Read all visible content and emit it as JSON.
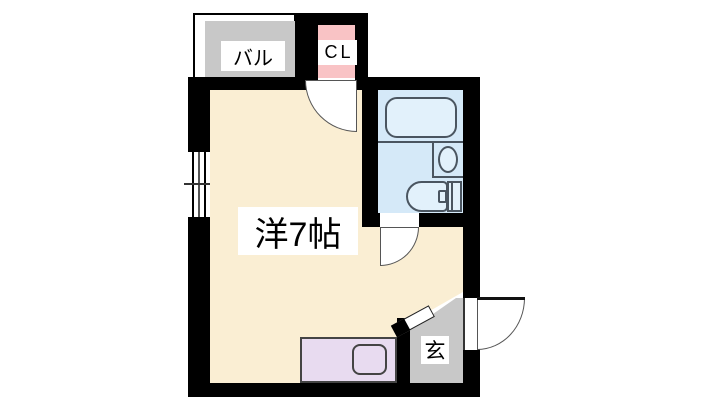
{
  "floorplan": {
    "type": "apartment-room-layout",
    "labels": {
      "balcony": "バル",
      "closet": "CL",
      "main_room": "洋7帖",
      "entrance": "玄"
    },
    "rooms": [
      {
        "name": "balcony",
        "label": "バル",
        "fill": "#C8C8C8"
      },
      {
        "name": "closet",
        "label": "CL",
        "fill": "#F9C3C5"
      },
      {
        "name": "western-room-7mat",
        "label": "洋7帖",
        "fill": "#FAEED3"
      },
      {
        "name": "bathroom",
        "label": "",
        "fill": "#D5E9F8"
      },
      {
        "name": "entrance",
        "label": "玄",
        "fill": "#C8C8C8"
      }
    ],
    "fixtures": [
      "bathtub",
      "sink-basin",
      "toilet",
      "kitchen-counter",
      "burner",
      "sliding-window",
      "hinged-doors"
    ],
    "colors": {
      "wall": "#000000",
      "background": "#FFFFFF",
      "room_floor": "#FAEED3",
      "balcony_fill": "#C8C8C8",
      "closet_fill": "#F9C3C5",
      "bathroom_fill": "#D5E9F8",
      "entrance_fill": "#C8C8C8",
      "kitchen_counter_fill": "#E8DBF0",
      "fixture_outline": "#4A5560"
    }
  }
}
